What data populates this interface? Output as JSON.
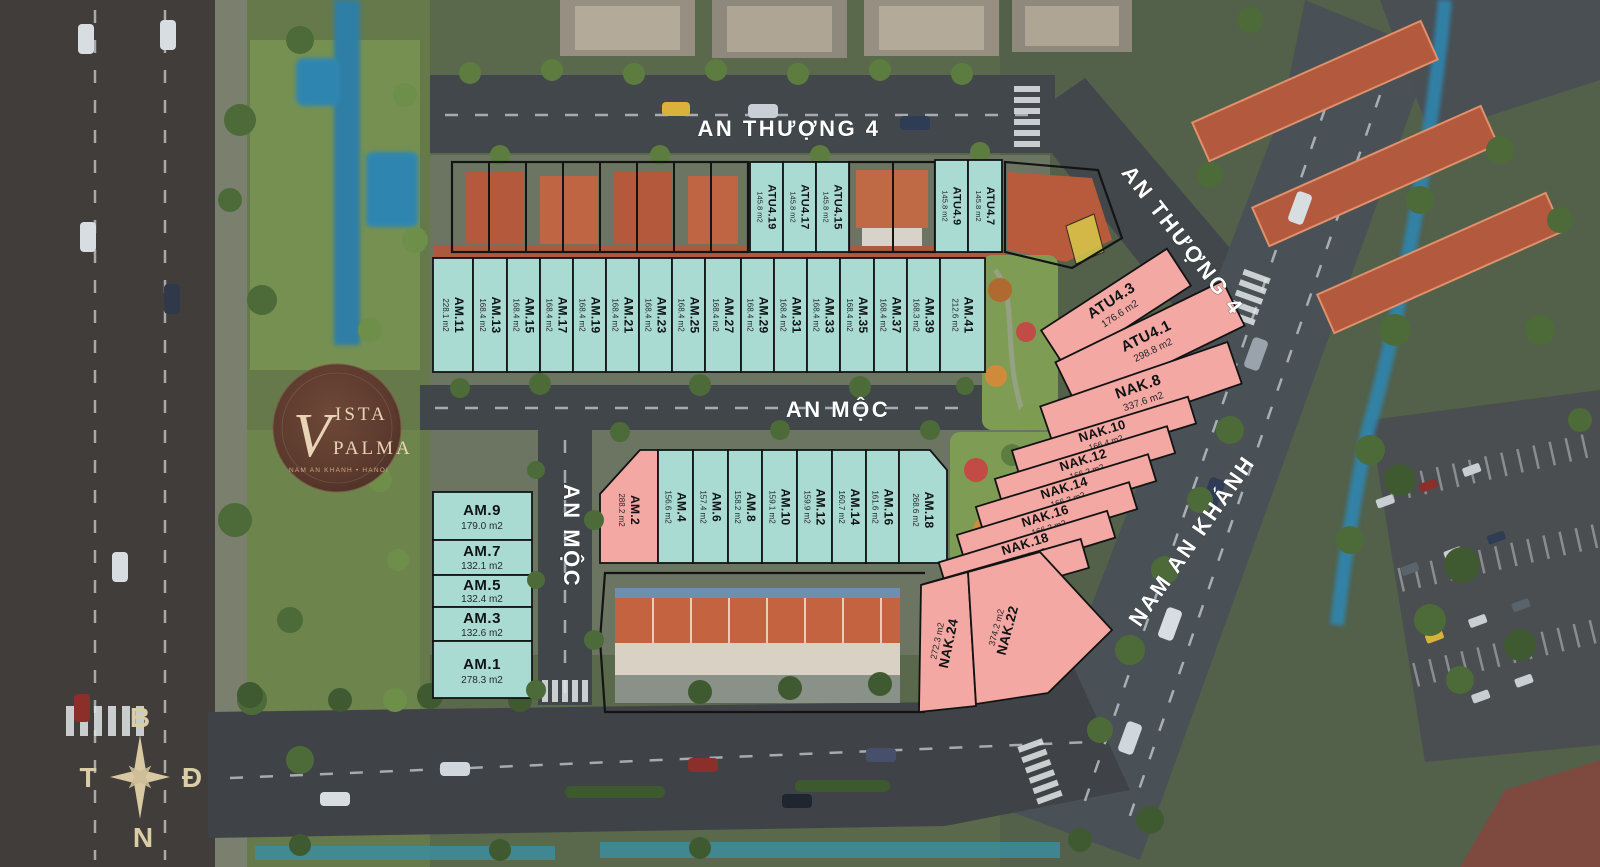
{
  "colors": {
    "teal": "#a9dbd3",
    "pink": "#f4a8a3",
    "outline": "#141414"
  },
  "streets": {
    "an_thuong_4_top": "AN THƯỢNG 4",
    "an_thuong_4_diag": "AN THƯỢNG 4",
    "an_moc_horizontal": "AN MỘC",
    "an_moc_vertical": "AN MỘC",
    "nam_an_khanh": "NAM AN KHÁNH"
  },
  "compass": {
    "north_label": "B",
    "east_label": "Đ",
    "south_label": "N",
    "west_label": "T"
  },
  "logo": {
    "initial": "V",
    "word_top": "ISTA",
    "word_bottom": "PALMA",
    "tagline": "NAM AN KHANH • HANOI"
  },
  "lots": {
    "atu_row": [
      {
        "name": "ATU4.19",
        "area": "145.8 m2"
      },
      {
        "name": "ATU4.17",
        "area": "145.8 m2"
      },
      {
        "name": "ATU4.15",
        "area": "145.8 m2"
      },
      {
        "name": "ATU4.9",
        "area": "145.8 m2"
      },
      {
        "name": "ATU4.7",
        "area": "145.8 m2"
      }
    ],
    "am_upper": [
      {
        "name": "AM.11",
        "area": "228.1 m2"
      },
      {
        "name": "AM.13",
        "area": "168.4 m2"
      },
      {
        "name": "AM.15",
        "area": "168.4 m2"
      },
      {
        "name": "AM.17",
        "area": "168.4 m2"
      },
      {
        "name": "AM.19",
        "area": "168.4 m2"
      },
      {
        "name": "AM.21",
        "area": "168.4 m2"
      },
      {
        "name": "AM.23",
        "area": "168.4 m2"
      },
      {
        "name": "AM.25",
        "area": "168.4 m2"
      },
      {
        "name": "AM.27",
        "area": "168.4 m2"
      },
      {
        "name": "AM.29",
        "area": "168.4 m2"
      },
      {
        "name": "AM.31",
        "area": "168.4 m2"
      },
      {
        "name": "AM.33",
        "area": "168.4 m2"
      },
      {
        "name": "AM.35",
        "area": "168.4 m2"
      },
      {
        "name": "AM.37",
        "area": "168.4 m2"
      },
      {
        "name": "AM.39",
        "area": "168.3 m2"
      },
      {
        "name": "AM.41",
        "area": "212.6 m2"
      }
    ],
    "am_lower": [
      {
        "name": "AM.2",
        "area": "288.2 m2"
      },
      {
        "name": "AM.4",
        "area": "156.6 m2"
      },
      {
        "name": "AM.6",
        "area": "157.4 m2"
      },
      {
        "name": "AM.8",
        "area": "158.2 m2"
      },
      {
        "name": "AM.10",
        "area": "159.1 m2"
      },
      {
        "name": "AM.12",
        "area": "159.9 m2"
      },
      {
        "name": "AM.14",
        "area": "160.7 m2"
      },
      {
        "name": "AM.16",
        "area": "161.6 m2"
      },
      {
        "name": "AM.18",
        "area": "268.6 m2"
      }
    ],
    "am_left": [
      {
        "name": "AM.9",
        "area": "179.0 m2"
      },
      {
        "name": "AM.7",
        "area": "132.1 m2"
      },
      {
        "name": "AM.5",
        "area": "132.4 m2"
      },
      {
        "name": "AM.3",
        "area": "132.6 m2"
      },
      {
        "name": "AM.1",
        "area": "278.3 m2"
      }
    ],
    "pink_block": [
      {
        "name": "ATU4.3",
        "area": "176.6 m2"
      },
      {
        "name": "ATU4.1",
        "area": "298.8 m2"
      },
      {
        "name": "NAK.8",
        "area": "337.6 m2"
      },
      {
        "name": "NAK.10",
        "area": "166.4 m2"
      },
      {
        "name": "NAK.12",
        "area": "166.2 m2"
      },
      {
        "name": "NAK.14",
        "area": "166.2 m2"
      },
      {
        "name": "NAK.16",
        "area": "166.2 m2"
      },
      {
        "name": "NAK.18",
        "area": "166.2 m2"
      },
      {
        "name": "NAK.20",
        "area": "169.9 m2"
      },
      {
        "name": "NAK.24",
        "area": "272.3 m2"
      },
      {
        "name": "NAK.22",
        "area": "374.2 m2"
      }
    ]
  }
}
